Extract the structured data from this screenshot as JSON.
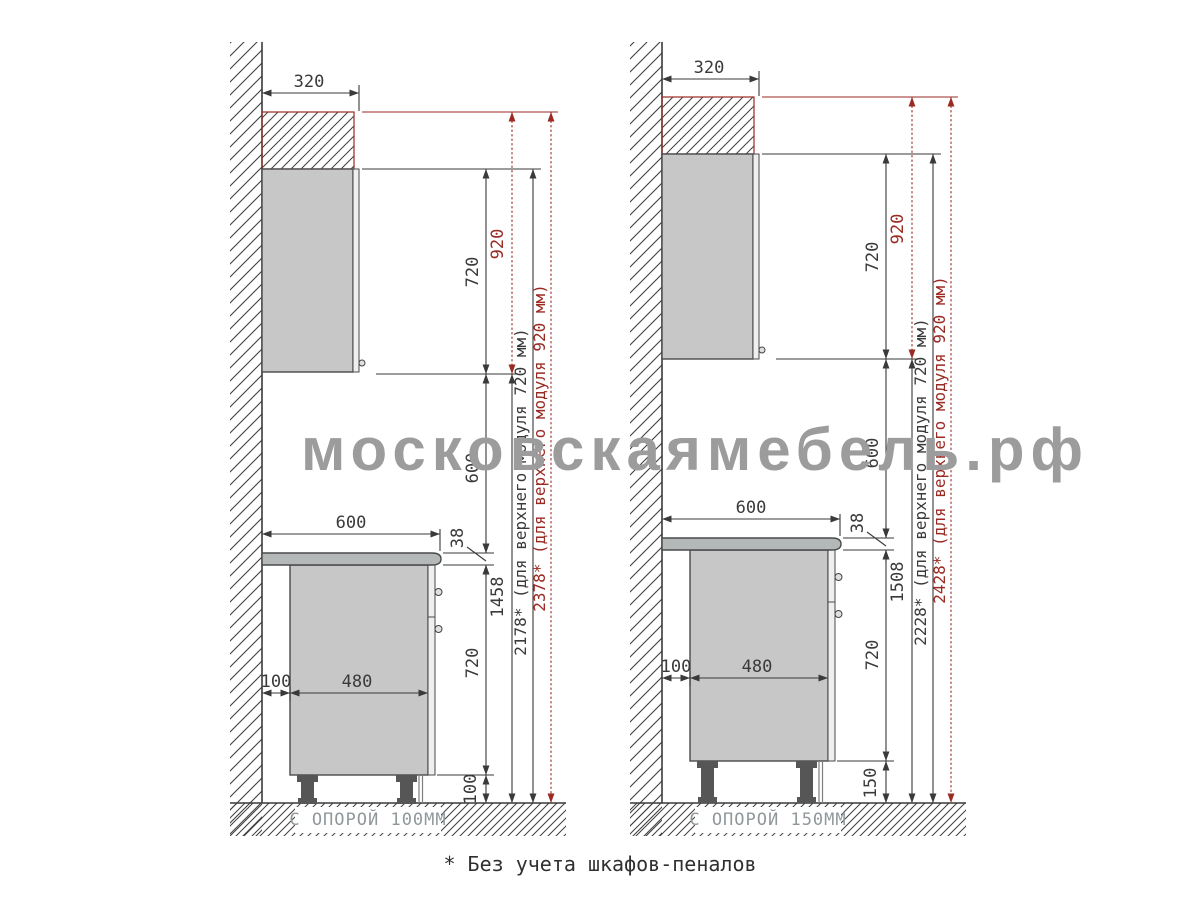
{
  "watermark": "московскаямебель.рф",
  "footnote": "* Без учета шкафов-пеналов",
  "colors": {
    "dimension": "#3a3a3a",
    "accent_red": "#9a2b23",
    "cabinet_fill": "#c7c7c7",
    "countertop_fill": "#b5b8b8",
    "watermark_gray": "#9c9c9c",
    "floor_label_gray": "#90989b"
  },
  "panels": [
    {
      "floor_label": "С ОПОРОЙ 100ММ",
      "top_width": "320",
      "upper_module_height": "720",
      "upper_module_alt_height": "920",
      "apron_gap": "600",
      "worktop_thickness": "38",
      "base_module_height": "720",
      "leg_height": "100",
      "wall_gap": "100",
      "base_depth": "480",
      "worktop_width": "600",
      "upper_bottom_to_floor": "1458",
      "total_for_720": "2178* (для верхнего модуля 720 мм)",
      "total_for_920": "2378* (для верхнего модуля 920 мм)"
    },
    {
      "floor_label": "С ОПОРОЙ 150ММ",
      "top_width": "320",
      "upper_module_height": "720",
      "upper_module_alt_height": "920",
      "apron_gap": "600",
      "worktop_thickness": "38",
      "base_module_height": "720",
      "leg_height": "150",
      "wall_gap": "100",
      "base_depth": "480",
      "worktop_width": "600",
      "upper_bottom_to_floor": "1508",
      "total_for_720": "2228* (для верхнего модуля 720 мм)",
      "total_for_920": "2428* (для верхнего модуля 920 мм)"
    }
  ]
}
